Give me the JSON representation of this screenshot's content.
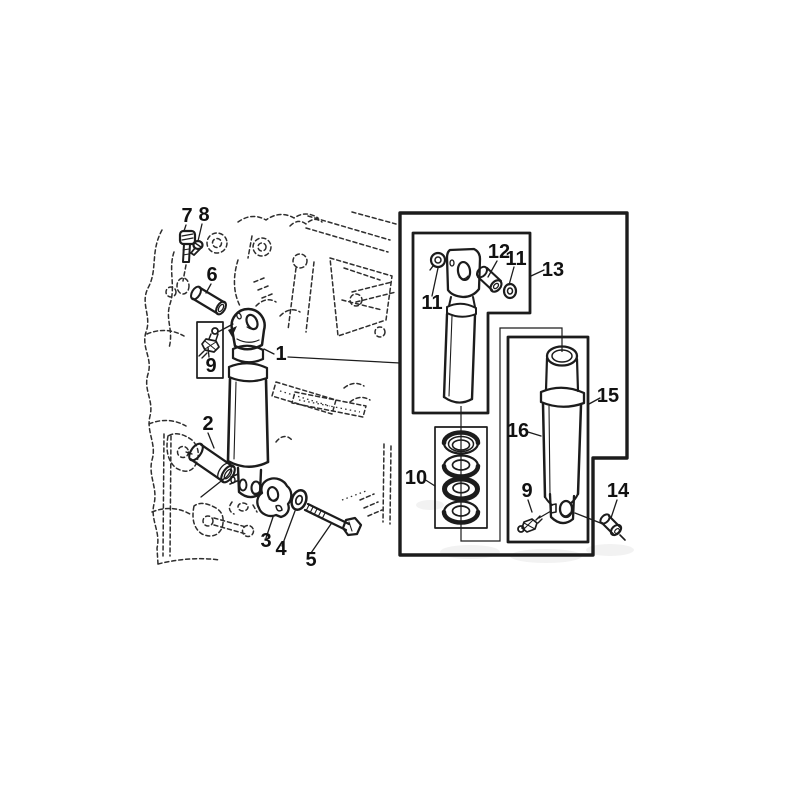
{
  "figure": {
    "type": "exploded-parts-diagram",
    "subject": "Hydraulic lift cylinder assembly mounted on tractor case, with boxed detail inset of cylinder components",
    "background_color": "#ffffff",
    "line_color": "#1c1c1c"
  },
  "callouts": {
    "part1": "1",
    "part2": "2",
    "part3": "3",
    "part4": "4",
    "part5": "5",
    "part6": "6",
    "part7": "7",
    "part8": "8",
    "part9_main": "9",
    "part9_detail": "9",
    "part10": "10",
    "part11_left": "11",
    "part11_right": "11",
    "part12": "12",
    "part13": "13",
    "part14": "14",
    "part15": "15",
    "part16": "16"
  }
}
